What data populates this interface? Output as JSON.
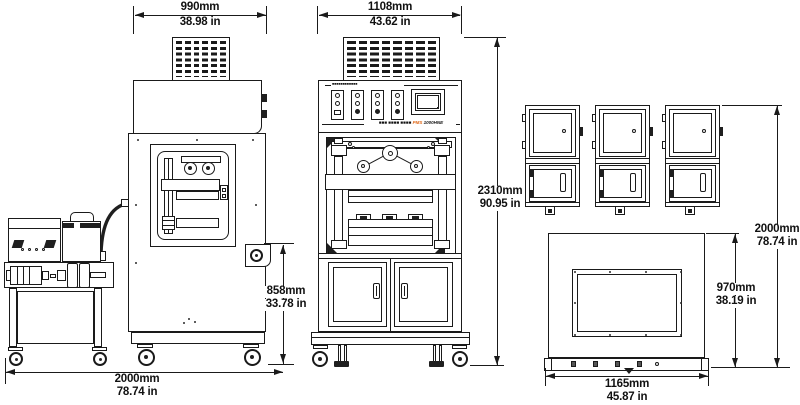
{
  "colors": {
    "line": "#1a1a1a",
    "brand_accent_orange": "#e06818"
  },
  "dimensions": {
    "side_width": {
      "mm": "990mm",
      "in": "38.98 in"
    },
    "front_width": {
      "mm": "1108mm",
      "in": "43.62 in"
    },
    "overall_height": {
      "mm": "2310mm",
      "in": "90.95 in"
    },
    "side_handle_height": {
      "mm": "858mm",
      "in": "33.78 in"
    },
    "floor_span": {
      "mm": "2000mm",
      "in": "78.74 in"
    },
    "right_stack_height": {
      "mm": "2000mm",
      "in": "78.74 in"
    },
    "top_view_depth": {
      "mm": "970mm",
      "in": "38.19 in"
    },
    "top_view_width": {
      "mm": "1165mm",
      "in": "45.87 in"
    }
  },
  "control_panel": {
    "header_microtext": "■■■■■■■■■■■■",
    "brand_left": "■■■ ■■■■ ■■■■",
    "brand_accent": "PMS",
    "brand_model": "1000HNE"
  }
}
